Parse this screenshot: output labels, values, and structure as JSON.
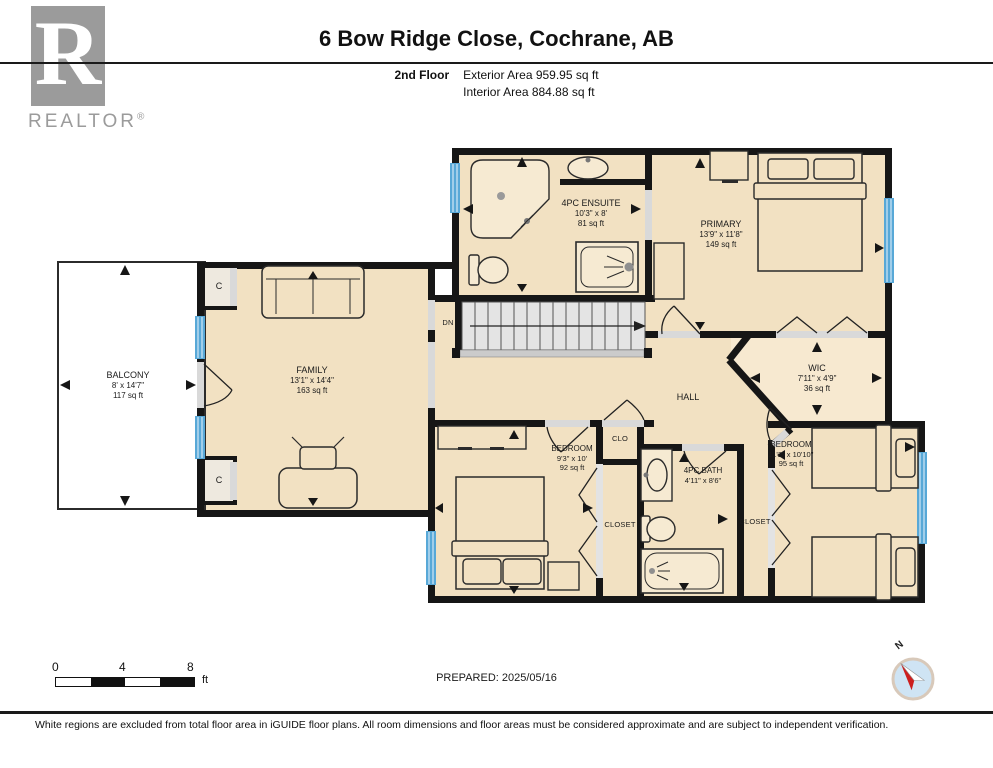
{
  "header": {
    "logo_r": "R",
    "logo_text": "REALTOR",
    "logo_reg": "®",
    "title": "6 Bow Ridge Close, Cochrane, AB",
    "floor_label": "2nd Floor",
    "exterior_area": "Exterior Area 959.95 sq ft",
    "interior_area": "Interior Area 884.88 sq ft"
  },
  "rooms": {
    "ensuite": {
      "name": "4PC ENSUITE",
      "dims": "10'3\" x 8'",
      "area": "81 sq ft"
    },
    "primary": {
      "name": "PRIMARY",
      "dims": "13'9\" x 11'8\"",
      "area": "149 sq ft"
    },
    "balcony": {
      "name": "BALCONY",
      "dims": "8' x 14'7\"",
      "area": "117 sq ft"
    },
    "family": {
      "name": "FAMILY",
      "dims": "13'1\" x 14'4\"",
      "area": "163 sq ft"
    },
    "wic": {
      "name": "WIC",
      "dims": "7'11\" x 4'9\"",
      "area": "36 sq ft"
    },
    "hall": {
      "name": "HALL"
    },
    "bedroom_left": {
      "name": "BEDROOM",
      "dims": "9'3\" x 10'",
      "area": "92 sq ft"
    },
    "bedroom_right": {
      "name": "BEDROOM",
      "dims": "11'2\" x 10'10\"",
      "area": "95 sq ft"
    },
    "bath": {
      "name": "4PC BATH",
      "dims": "4'11\" x 8'6\""
    },
    "clo": {
      "name": "CLO"
    },
    "closet_left": {
      "name": "CLOSET"
    },
    "closet_right": {
      "name": "CLOSET"
    },
    "stairs": {
      "name": "DN"
    },
    "closet_c": {
      "name": "C"
    }
  },
  "scale_bar": {
    "tick0": "0",
    "tick1": "4",
    "tick2": "8",
    "unit": "ft"
  },
  "compass": {
    "north": "N"
  },
  "footer": {
    "prepared": "PREPARED: 2025/05/16",
    "disclaimer": "White regions are excluded from total floor area in iGUIDE floor plans. All room dimensions and floor areas must be considered approximate and are subject to independent verification."
  },
  "colors": {
    "wall": "#161616",
    "room_fill": "#f2e1c2",
    "room_fill_light": "#f7e9d0",
    "window_blue": "#58a8d7",
    "stair_gray": "#e4e4e4",
    "compass_red": "#cc1f1f"
  }
}
